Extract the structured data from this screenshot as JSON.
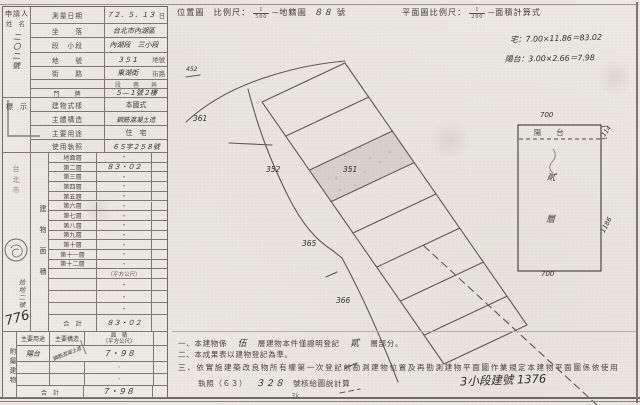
{
  "colors": {
    "paper": "#edeae3",
    "ink": "#45423c",
    "handwriting": "#2f2d28",
    "grid_line": "#7d7870"
  },
  "applicant": {
    "spine_title": "申請人",
    "spine_sub": "姓　名",
    "handwriting_vertical": "二〇二號"
  },
  "form": {
    "block1": {
      "rows": [
        {
          "label": "測量日期",
          "hand": "７２．５．１３",
          "suffix": "日"
        },
        {
          "label": "坐　　落",
          "hand": "台北市內湖區",
          "suffix": ""
        },
        {
          "label": "段　小段",
          "hand": "內湖段　三小段",
          "suffix": ""
        },
        {
          "label": "地　　號",
          "hand": "３５１",
          "suffix": "地號"
        },
        {
          "label": "街　　路",
          "hand": "東湖街",
          "suffix": "街路"
        },
        {
          "label": "",
          "hand": "",
          "suffix": "段　　巷　　弄"
        },
        {
          "label": "門　　牌",
          "hand": "５—１號２樓",
          "suffix": ""
        }
      ]
    },
    "block2": {
      "spine": "標　示",
      "rows": [
        {
          "label": "建物式樣",
          "value": "本國式",
          "hand": ""
        },
        {
          "label": "主體構造",
          "value": "",
          "hand": "鋼筋混凝土造"
        },
        {
          "label": "主要用途",
          "value": "住　宅",
          "hand": ""
        },
        {
          "label": "使用執照",
          "value": "",
          "hand": "６５字２５８號"
        }
      ]
    },
    "area_section": {
      "column_title": "建物面積",
      "floors": [
        "地面層",
        "第二層",
        "第三層",
        "第四層",
        "第五層",
        "第六層",
        "第七層",
        "第八層",
        "第九層",
        "第十層",
        "第十一層",
        "第十二層"
      ],
      "values": [
        "・",
        "８３・０２",
        "・",
        "・",
        "・",
        "・",
        "・",
        "・",
        "・",
        "・",
        "・",
        "・"
      ],
      "unit_note": "（平方公尺）",
      "dot": "・",
      "total_label": "合　計",
      "total_value": "８３・０２",
      "spine_city": "台北市",
      "spine_hand": "拾地二號",
      "spine_number": "776"
    },
    "annex": {
      "spine": "附屬建物",
      "headers": {
        "use": "主要用途",
        "structure": "主要構造",
        "area_line1": "面　積",
        "area_line2": "（平方公尺）"
      },
      "row": {
        "use": "陽台",
        "structure": "鋼筋混凝土造",
        "area": "７・９８"
      },
      "dot": "・",
      "total_label": "合　計",
      "total_value": "７・９８"
    }
  },
  "site_map": {
    "title": "位置圖",
    "scale_label": "比例尺：",
    "scale_num": "1",
    "scale_den": "500",
    "after_scale": "─地籍圖",
    "sheet_hand": "８８",
    "sheet_suffix": "號",
    "parcel_labels": {
      "small": "452",
      "l361": "361",
      "l352": "352",
      "l351": "351",
      "l365": "365",
      "l366": "366"
    }
  },
  "floor_plan": {
    "header_label": "平面圖比例尺：",
    "scale_num": "1",
    "scale_den": "200",
    "header_suffix": "─面積計算式",
    "calc_line1": "宅：7.00×11.86＝83.02",
    "calc_line2": "陽台：3.00×2.66＝7.98",
    "dim_top": "700",
    "dim_right_top": "114",
    "dim_right": "1186",
    "dim_bottom": "700",
    "balcony_label": "陽　台",
    "interior_chars": [
      "貳",
      "層"
    ]
  },
  "notes": {
    "n1_pre": "一、本建物係",
    "n1_hand1": "伍",
    "n1_mid": "層建物本件僅證明登記",
    "n1_hand2": "貳",
    "n1_post": "層部分。",
    "n2": "二、本成果表以建物登記為準。",
    "n3": "三、依實施建築改良物所有權第一次登記前勘測建物位置及再勘測建物平面圖作業規定本建物平面圖係依使用",
    "n4_pre": "執照（６３）",
    "n4_hand": "３２８",
    "n4_post": "號核給圖說計算",
    "lot_hand": "3小段建號 1376",
    "page_mark": "3k"
  }
}
